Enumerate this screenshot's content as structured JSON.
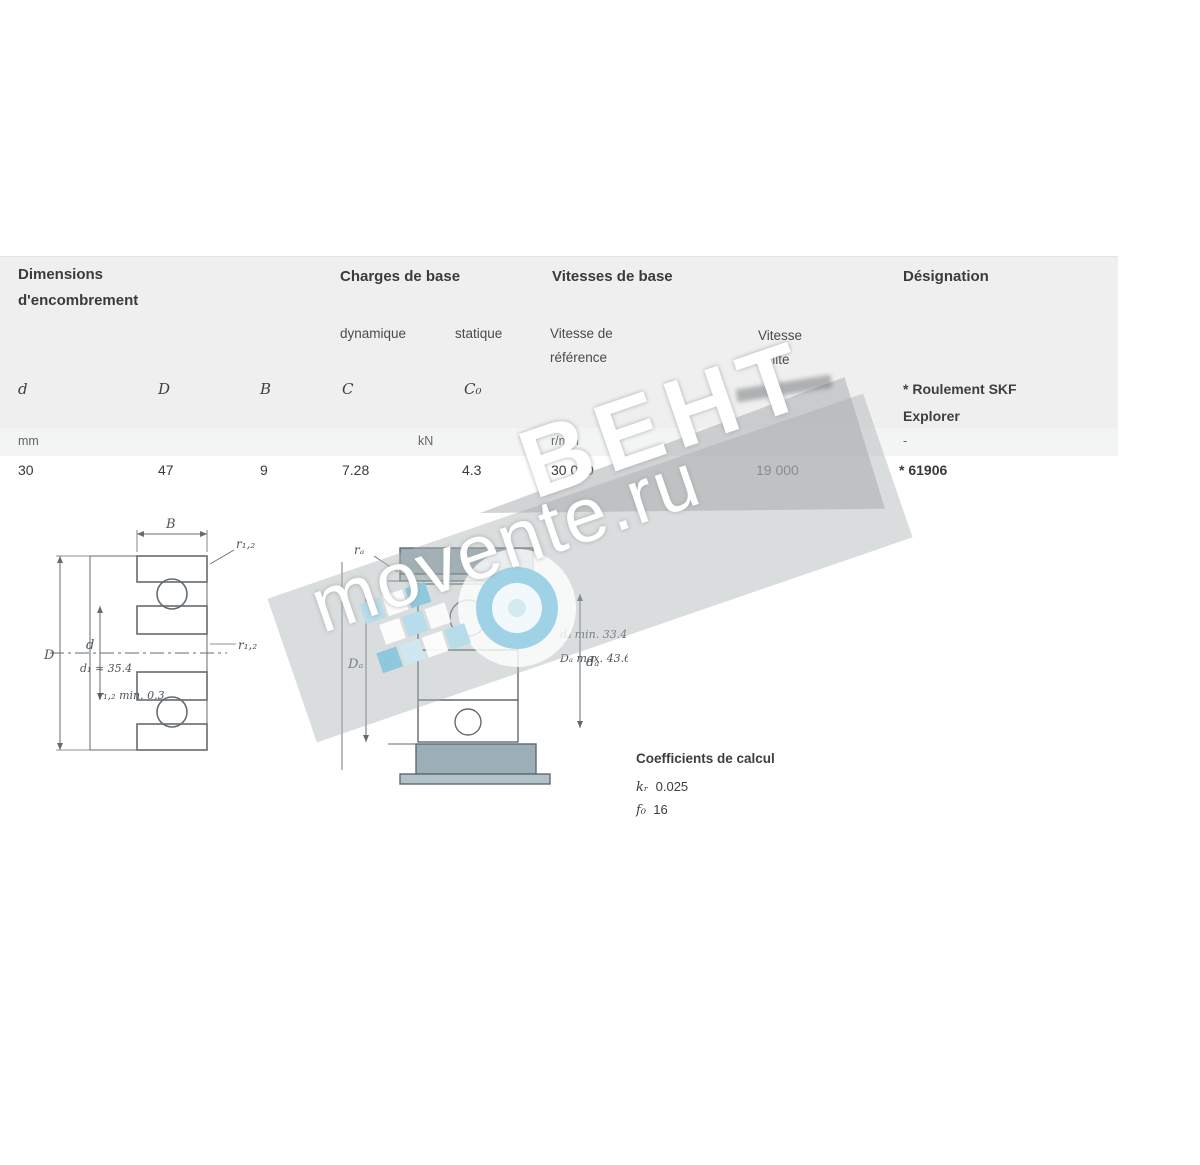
{
  "table": {
    "groups": {
      "dims_line1": "Dimensions",
      "dims_line2": "d'encombrement",
      "loads": "Charges de base",
      "speeds": "Vitesses de base",
      "designation": "Désignation"
    },
    "subheaders": {
      "dynamic": "dynamique",
      "static": "statique",
      "ref_speed_line1": "Vitesse de",
      "ref_speed_line2": "référence",
      "lim_speed_line1": "Vitesse",
      "lim_speed_line2": "limite"
    },
    "symbols": {
      "d": "d",
      "D": "D",
      "B": "B",
      "C": "C",
      "C0": "C₀"
    },
    "explorer_note_line1": "* Roulement SKF",
    "explorer_note_line2": "Explorer",
    "units": {
      "dims": "mm",
      "loads": "kN",
      "speeds": "r/min",
      "designation": "-"
    },
    "row": {
      "d": "30",
      "D": "47",
      "B": "9",
      "C": "7.28",
      "C0": "4.3",
      "ref_speed": "30 000",
      "lim_speed": "19 000",
      "designation": "* 61906"
    }
  },
  "drawing_left": {
    "B": "B",
    "r12_top": "r₁,₂",
    "d": "d",
    "D": "D",
    "r12_side": "r₁,₂",
    "d1_note": "d₁ ≈ 35.4",
    "rmin_note": "r₁,₂ min. 0.3"
  },
  "drawing_right": {
    "ra": "rₐ",
    "Da": "Dₐ",
    "da": "dₐ",
    "da_note": "dₐ min. 33.4",
    "Da_note": "Dₐ max. 43.6"
  },
  "factors": {
    "title": "Coefficients de calcul",
    "kr_label": "kᵣ",
    "kr_value": "0.025",
    "f0_label": "f₀",
    "f0_value": "16"
  },
  "watermark": {
    "brand": "ВЕНТ",
    "site": "movente.ru",
    "accent": "#9fd2e6"
  }
}
